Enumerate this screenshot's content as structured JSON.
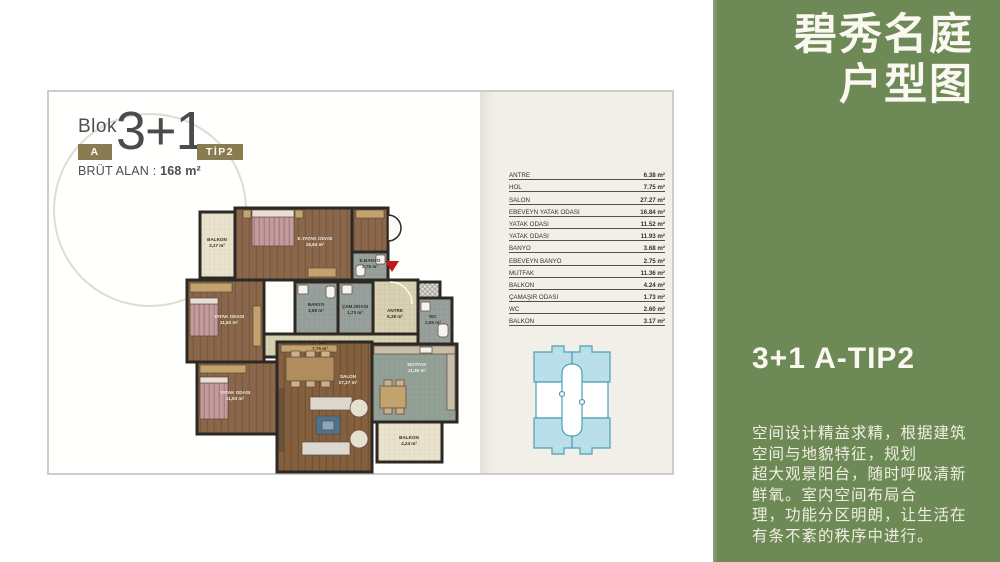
{
  "logo": {
    "blok_label": "Blok",
    "block_badge": "A",
    "plan_type": "3+1",
    "tip_badge": "TİP2",
    "brut_label": "BRÜT ALAN :",
    "brut_value": "168 m²",
    "badge_color": "#8a7c52"
  },
  "area_table": {
    "rows": [
      {
        "name": "ANTRE",
        "value": "6.38 m²"
      },
      {
        "name": "HOL",
        "value": "7.75 m²"
      },
      {
        "name": "SALON",
        "value": "27.27 m²"
      },
      {
        "name": "EBEVEYN YATAK ODASI",
        "value": "16.84 m²"
      },
      {
        "name": "YATAK ODASI",
        "value": "11.52 m²"
      },
      {
        "name": "YATAK ODASI",
        "value": "11.93 m²"
      },
      {
        "name": "BANYO",
        "value": "3.68 m²"
      },
      {
        "name": "EBEVEYN BANYO",
        "value": "2.75 m²"
      },
      {
        "name": "MUTFAK",
        "value": "11.36 m²"
      },
      {
        "name": "BALKON",
        "value": "4.24 m²"
      },
      {
        "name": "ÇAMAŞIR ODASI",
        "value": "1.73 m²"
      },
      {
        "name": "WC",
        "value": "2.60 m²"
      },
      {
        "name": "BALKON",
        "value": "3.17 m²"
      }
    ]
  },
  "floor_plan": {
    "rooms": [
      {
        "name": "BALKON",
        "area": "3,17 m²"
      },
      {
        "name": "E.YATAK ODASI",
        "area": "16,84 m²"
      },
      {
        "name": "E.BANYO",
        "area": "2,75 m²"
      },
      {
        "name": "YATAK ODASI",
        "area": "11,52 m²"
      },
      {
        "name": "BANYO",
        "area": "3,68 m²"
      },
      {
        "name": "ÇAM.ODASI",
        "area": "1,73 m²"
      },
      {
        "name": "ANTRE",
        "area": "6,38 m²"
      },
      {
        "name": "WC",
        "area": "2,60 m²"
      },
      {
        "name": "HOL",
        "area": "7,75 m²"
      },
      {
        "name": "YATAK ODASI",
        "area": "11,93 m²"
      },
      {
        "name": "SALON",
        "area": "27,27 m²"
      },
      {
        "name": "MUTFAK",
        "area": "11,36 m²"
      },
      {
        "name": "BALKON",
        "area": "4,24 m²"
      }
    ],
    "entrance_marker_color": "#c4161c",
    "wall_color": "#2c2824"
  },
  "key_plan": {
    "unit_fill": "#badfe9",
    "outline": "#4aa0b8"
  },
  "side_panel": {
    "bg": "#6d8a56",
    "title_line1": "碧秀名庭",
    "title_line2": "户型图",
    "subtitle": "3+1 A-TIP2",
    "body_lines": [
      "空间设计精益求精，根据建筑",
      "空间与地貌特征，规划",
      "超大观景阳台，随时呼吸清新",
      "鲜氧。室内空间布局合",
      "理，功能分区明朗，让生活在",
      "有条不紊的秩序中进行。"
    ]
  }
}
